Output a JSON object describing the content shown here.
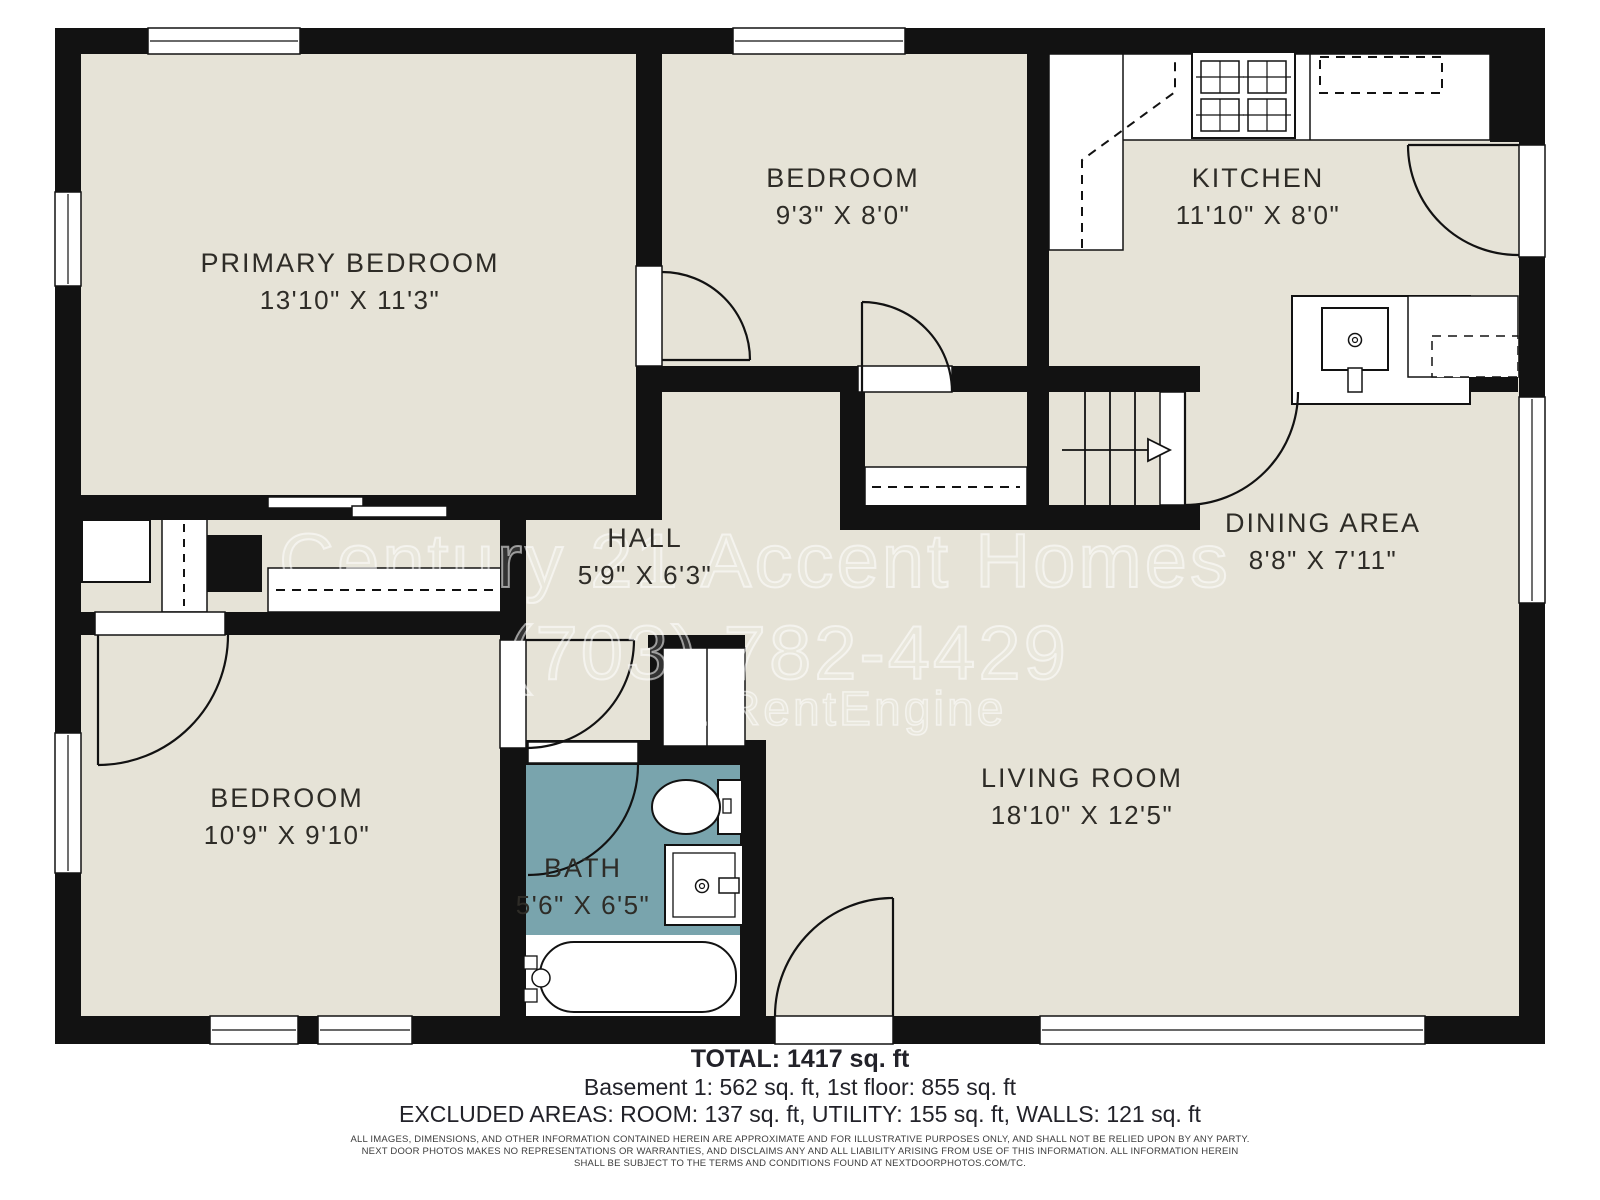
{
  "rooms": [
    {
      "name": "PRIMARY BEDROOM",
      "dims": "13'10\" X 11'3\""
    },
    {
      "name": "BEDROOM",
      "dims": "9'3\" X 8'0\""
    },
    {
      "name": "KITCHEN",
      "dims": "11'10\" X 8'0\""
    },
    {
      "name": "HALL",
      "dims": "5'9\" X 6'3\""
    },
    {
      "name": "DINING AREA",
      "dims": "8'8\" X 7'11\""
    },
    {
      "name": "BEDROOM",
      "dims": "10'9\" X 9'10\""
    },
    {
      "name": "BATH",
      "dims": "5'6\" X 6'5\""
    },
    {
      "name": "LIVING ROOM",
      "dims": "18'10\" X 12'5\""
    }
  ],
  "watermark": {
    "line1": "Century 21 Accent Homes",
    "line2": "(703) 782-4429",
    "line3": "a RentEngine"
  },
  "footer": {
    "total": "TOTAL: 1417 sq. ft",
    "breakdown": "Basement 1: 562 sq. ft, 1st floor: 855 sq. ft",
    "excluded": "EXCLUDED AREAS: ROOM: 137 sq. ft, UTILITY: 155 sq. ft, WALLS: 121 sq. ft",
    "disclaimer1": "ALL IMAGES, DIMENSIONS, AND OTHER INFORMATION CONTAINED HEREIN ARE APPROXIMATE AND FOR ILLUSTRATIVE PURPOSES ONLY, AND SHALL NOT BE RELIED UPON BY ANY PARTY.",
    "disclaimer2": "NEXT DOOR PHOTOS MAKES NO REPRESENTATIONS OR WARRANTIES, AND DISCLAIMS ANY AND ALL LIABILITY ARISING FROM USE OF THIS INFORMATION. ALL INFORMATION HEREIN",
    "disclaimer3": "SHALL BE SUBJECT TO THE TERMS AND CONDITIONS FOUND AT NEXTDOORPHOTOS.COM/TC."
  },
  "colors": {
    "floor": "#E6E3D7",
    "wall": "#121212",
    "bath_floor": "#79A4AD",
    "background": "#FFFFFF"
  }
}
